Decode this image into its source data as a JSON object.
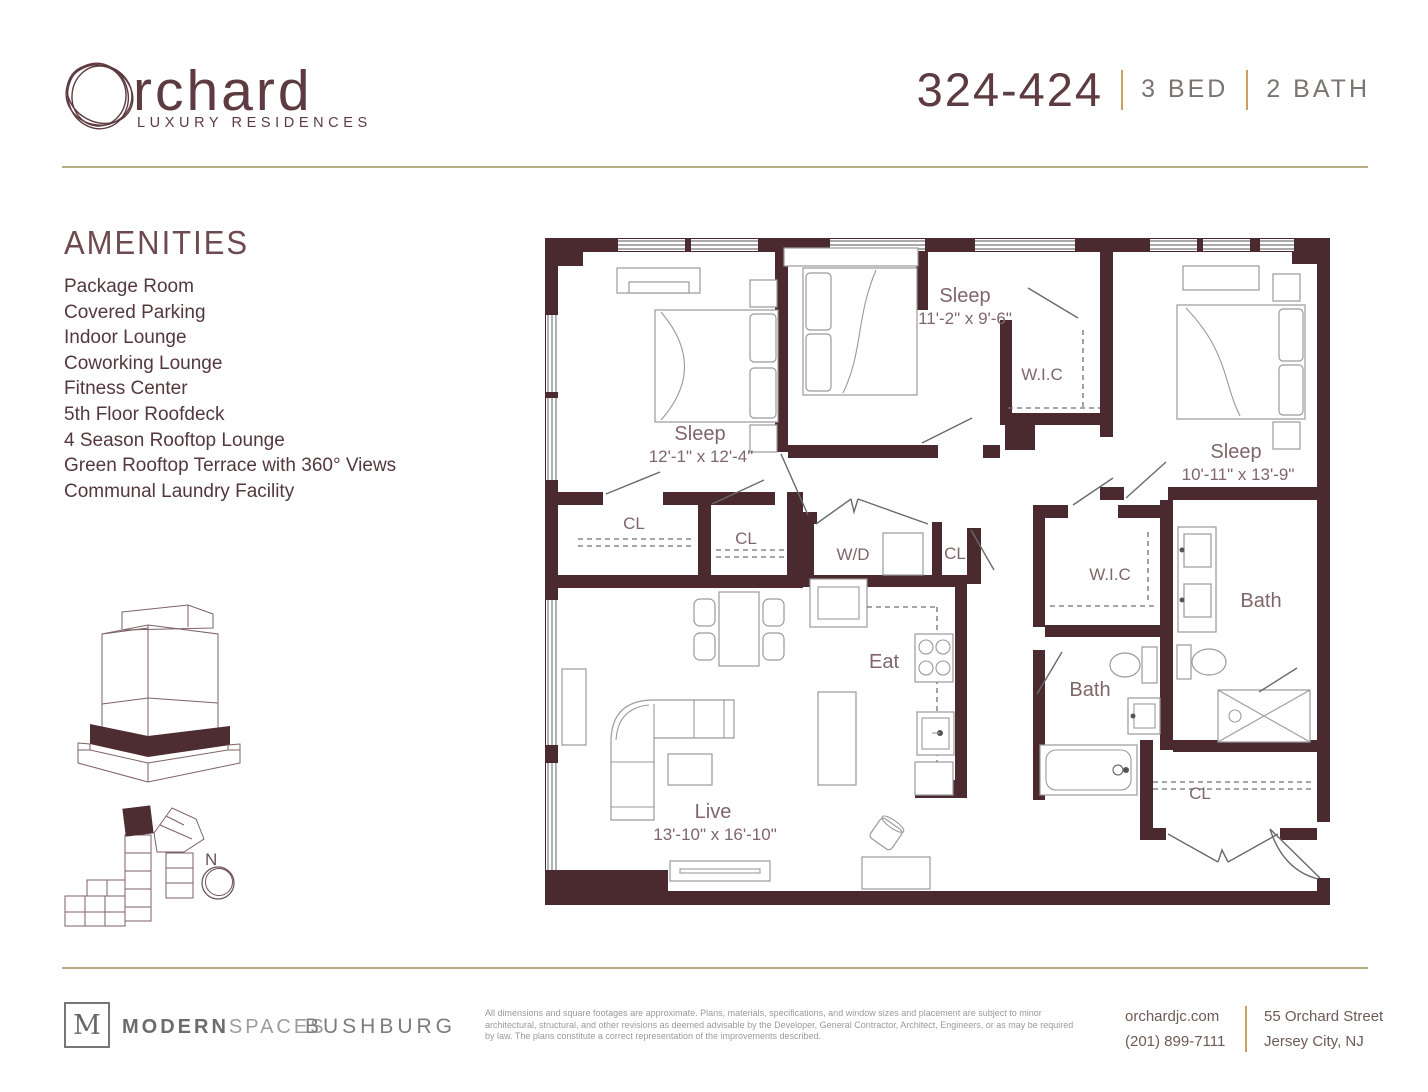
{
  "brand": {
    "name_rest": "rchard",
    "tagline": "LUXURY RESIDENCES"
  },
  "unit": {
    "number": "324-424",
    "bed": "3 BED",
    "bath": "2 BATH"
  },
  "amenities": {
    "heading": "AMENITIES",
    "items": [
      {
        "label": "Package Room"
      },
      {
        "label": "Covered Parking"
      },
      {
        "label": "Indoor Lounge"
      },
      {
        "label": "Coworking Lounge"
      },
      {
        "label": "Fitness Center"
      },
      {
        "label": "5th Floor Roofdeck"
      },
      {
        "label": "4 Season Rooftop Lounge"
      },
      {
        "label": "Green Rooftop Terrace with 360° Views"
      },
      {
        "label": "Communal Laundry Facility"
      }
    ]
  },
  "floor_plan": {
    "rooms": {
      "sleep1": {
        "name": "Sleep",
        "dims": "12'-1\" x 12'-4\""
      },
      "sleep2": {
        "name": "Sleep",
        "dims": "11'-2\" x 9'-6\""
      },
      "sleep3": {
        "name": "Sleep",
        "dims": "10'-11\" x 13'-9\""
      },
      "live": {
        "name": "Live",
        "dims": "13'-10\" x 16'-10\""
      },
      "eat": "Eat",
      "wd": "W/D",
      "wic1": "W.I.C",
      "wic2": "W.I.C",
      "bath1": "Bath",
      "bath2": "Bath",
      "cl1": "CL",
      "cl2": "CL",
      "cl3": "CL",
      "cl4": "CL"
    },
    "compass_label": "N"
  },
  "footer": {
    "m_logo": "M",
    "modern": "MODERN",
    "spaces": "SPACES",
    "bushburg": "BUSHBURG",
    "disclaimer": "All dimensions and square footages are approximate. Plans, materials, specifications, and window sizes and placement are subject to minor architectural, structural, and other revisions as deemed advisable by the Developer, General Contractor, Architect, Engineers, or as may be required by law. The plans constitute a correct representation of the improvements described.",
    "website": "orchardjc.com",
    "phone": "(201) 899-7111",
    "address_line1": "55 Orchard Street",
    "address_line2": "Jersey City, NJ"
  },
  "colors": {
    "wall": "#4a2a2f",
    "accent_gold": "#c99f63",
    "rule": "#b6ad84",
    "title": "#5d3b41",
    "label": "#7f666a"
  }
}
